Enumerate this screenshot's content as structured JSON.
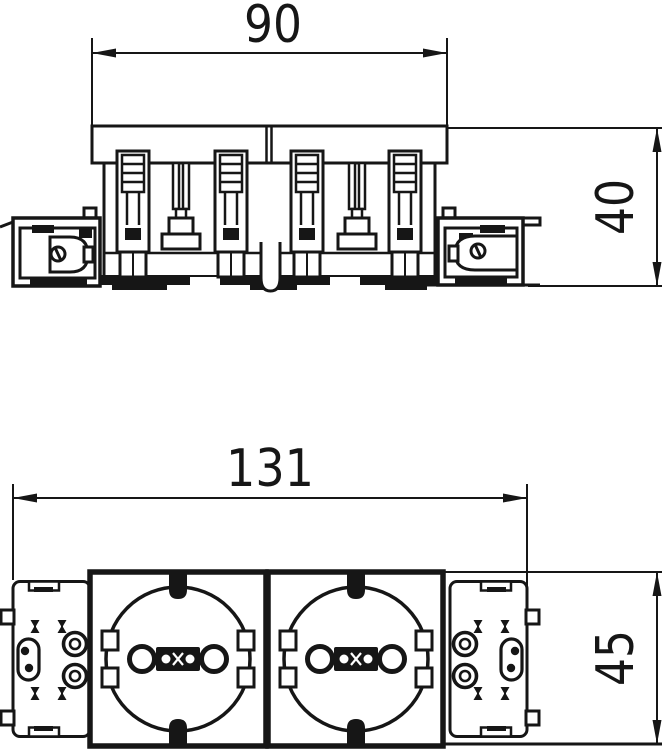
{
  "colors": {
    "line": "#161616",
    "background": "#ffffff"
  },
  "dims": {
    "side_width": "90",
    "side_height": "40",
    "front_width": "131",
    "front_height": "45"
  }
}
